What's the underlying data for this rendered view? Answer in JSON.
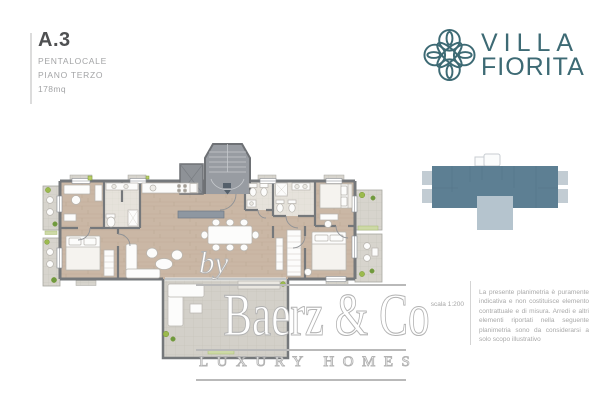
{
  "header": {
    "unit": "A.3",
    "type": "PENTALOCALE",
    "floor": "PIANO TERZO",
    "area": "178mq"
  },
  "logo": {
    "name_line1": "VILLA",
    "name_line2": "FIORITA",
    "icon": "flower-knot-icon",
    "color": "#3d6a74"
  },
  "watermark": {
    "by": "by",
    "brand": "Baerz & Co",
    "tagline": "LUXURY HOMES"
  },
  "footer": {
    "scale_label": "scala 1:200",
    "disclaimer": "La presente planimetria è puramente indicativa e non costituisce elemento contrattuale e di misura. Arredi e altri elementi riportati nella seguente planimetria sono da considerarsi a solo scopo illustrativo"
  },
  "colors": {
    "logo_teal": "#3d6a74",
    "wall_gray": "#75787b",
    "floor_wood": "#cab7a5",
    "balcony_tile": "#d7d4cd",
    "terrace_tile": "#d3d0c9",
    "bath_tile": "#e6e2db",
    "plant_green": "#9cba4e",
    "keyplan_body": "#5d7f93",
    "keyplan_terrace": "#b5c4ce",
    "keyplan_side": "#c2ccd3",
    "watermark_outline": "#b3b3b3",
    "text_dark": "#4f5052",
    "text_muted": "#a3a4a6"
  }
}
